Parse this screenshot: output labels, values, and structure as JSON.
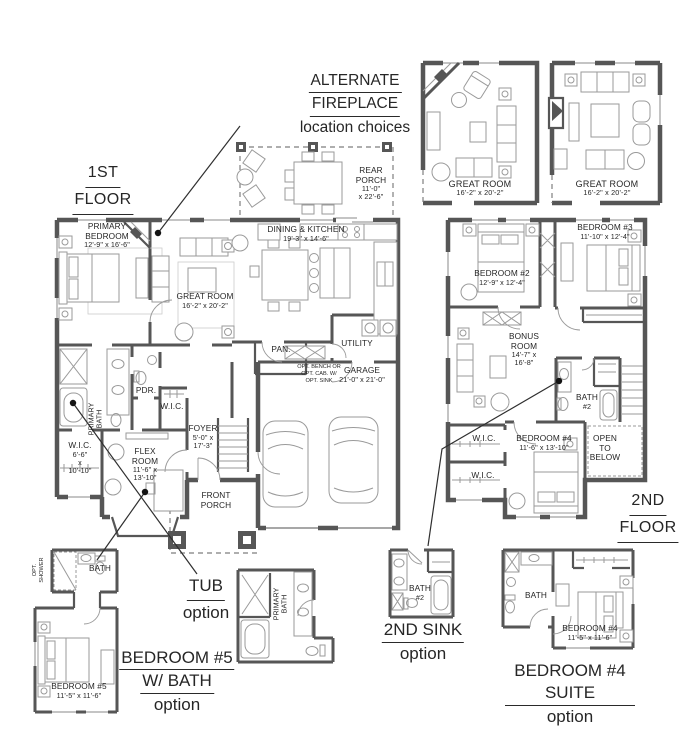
{
  "colors": {
    "wall": "#565656",
    "furniture": "#9a9a9a",
    "text": "#262626",
    "background": "#ffffff"
  },
  "titles": {
    "floor1_l1": "1ST",
    "floor1_l2": "FLOOR",
    "floor2_l1": "2ND",
    "floor2_l2": "FLOOR",
    "alt_l1": "ALTERNATE",
    "alt_l2": "FIREPLACE",
    "alt_l3": "location choices"
  },
  "floor1": {
    "primary_bedroom": {
      "name": "PRIMARY BEDROOM",
      "dims": "12'-9\" x 16'-6\""
    },
    "great_room": {
      "name": "GREAT ROOM",
      "dims": "16'-2\" x 20'-2\""
    },
    "dining_kitchen": {
      "name": "DINING & KITCHEN",
      "dims": "19'-3\" x 14'-6\""
    },
    "rear_porch": {
      "name": "REAR PORCH",
      "dims1": "11'-0\"",
      "dims2": "x 22'-6\""
    },
    "pantry": "PAN.",
    "utility": "UTILITY",
    "garage": {
      "name": "GARAGE",
      "dims": "21'-0\" x 21'-0\""
    },
    "opt_bench1": "OPT. BENCH OR",
    "opt_bench2": "OPT. CAB. W/",
    "opt_bench3": "OPT. SINK",
    "primary_bath1": "PRIMARY",
    "primary_bath2": "BATH",
    "powder": "PDR.",
    "wic_hall": "W.I.C.",
    "wic": {
      "name": "W.I.C.",
      "dims1": "6'-6\"",
      "dims2": "x",
      "dims3": "10'-10\""
    },
    "flex": {
      "name": "FLEX ROOM",
      "dims1": "11'-6\" x",
      "dims2": "13'-10\""
    },
    "foyer": {
      "name": "FOYER",
      "dims1": "5'-0\" x",
      "dims2": "17'-3\""
    },
    "front_porch": "FRONT PORCH"
  },
  "floor2": {
    "bedroom2": {
      "name": "BEDROOM #2",
      "dims": "12'-9\" x 12'-4\""
    },
    "bedroom3": {
      "name": "BEDROOM #3",
      "dims": "11'-10\" x 12'-4\""
    },
    "bonus": {
      "name": "BONUS ROOM",
      "dims1": "14'-7\" x",
      "dims2": "16'-8\""
    },
    "bath2_l1": "BATH",
    "bath2_l2": "#2",
    "wic_a": "W.I.C.",
    "wic_b": "W.I.C.",
    "bedroom4": {
      "name": "BEDROOM #4",
      "dims": "11'-6\" x 13'-10\""
    },
    "open1": "OPEN",
    "open2": "TO",
    "open3": "BELOW"
  },
  "alternates": {
    "a": {
      "name": "GREAT ROOM",
      "dims": "16'-2\" x 20'-2\""
    },
    "b": {
      "name": "GREAT ROOM",
      "dims": "16'-2\" x 20'-2\""
    }
  },
  "options": {
    "tub": {
      "t1": "TUB",
      "t2": "option",
      "bath1": "PRIMARY",
      "bath2": "BATH"
    },
    "b5": {
      "t1": "BEDROOM #5",
      "t2": "W/ BATH",
      "t3": "option",
      "bath": "BATH",
      "shower1": "OPT.",
      "shower2": "SHOWER",
      "room": "BEDROOM #5",
      "dims": "11'-5\" x 11'-6\""
    },
    "sink": {
      "t1": "2ND SINK",
      "t2": "option",
      "bath1": "BATH",
      "bath2": "#2"
    },
    "b4": {
      "t1": "BEDROOM #4 SUITE",
      "t2": "option",
      "bath": "BATH",
      "room": "BEDROOM #4",
      "dims": "11'-5\" x 11'-6\""
    }
  }
}
